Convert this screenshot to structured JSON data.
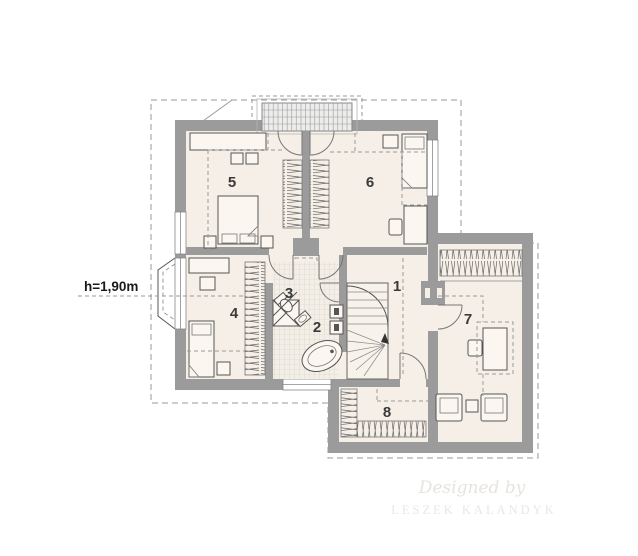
{
  "plan": {
    "height_annotation": "h=1,90m",
    "rooms": [
      {
        "label": "1"
      },
      {
        "label": "2"
      },
      {
        "label": "3"
      },
      {
        "label": "4"
      },
      {
        "label": "5"
      },
      {
        "label": "6"
      },
      {
        "label": "7"
      },
      {
        "label": "8"
      }
    ],
    "watermark": {
      "line1": "Designed by",
      "line2": "LESZEK KALANDYK"
    },
    "colors": {
      "wall": "#9b9b9b",
      "floor": "#f6efe7",
      "tile": "#f3eee6",
      "stairs": "#f8f3ea",
      "line": "#555555",
      "dashed": "#999999",
      "label": "#3a3a3a",
      "glazing": "#ededec",
      "watermark_script": "#e7e4e0",
      "watermark_caps": "#eae7e3",
      "background": "#ffffff"
    }
  }
}
